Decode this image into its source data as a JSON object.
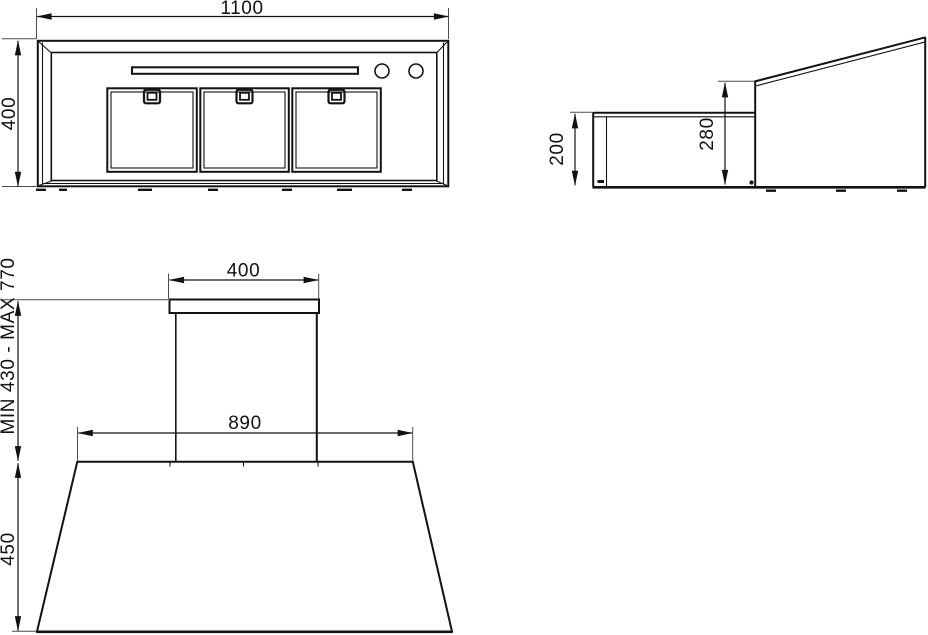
{
  "colors": {
    "background": "#ffffff",
    "line": "#121212",
    "thin_line": "#4d4d4d"
  },
  "views": {
    "bottom_view": {
      "dims": {
        "width": "1100",
        "depth": "400"
      }
    },
    "side_view": {
      "dims": {
        "front_height": "200",
        "rear_height": "280"
      }
    },
    "front_view": {
      "dims": {
        "chimney_width": "400",
        "hood_top_width": "890",
        "canopy_height": "450",
        "chimney_height_range": "MIN 430 - MAX 770"
      }
    }
  }
}
